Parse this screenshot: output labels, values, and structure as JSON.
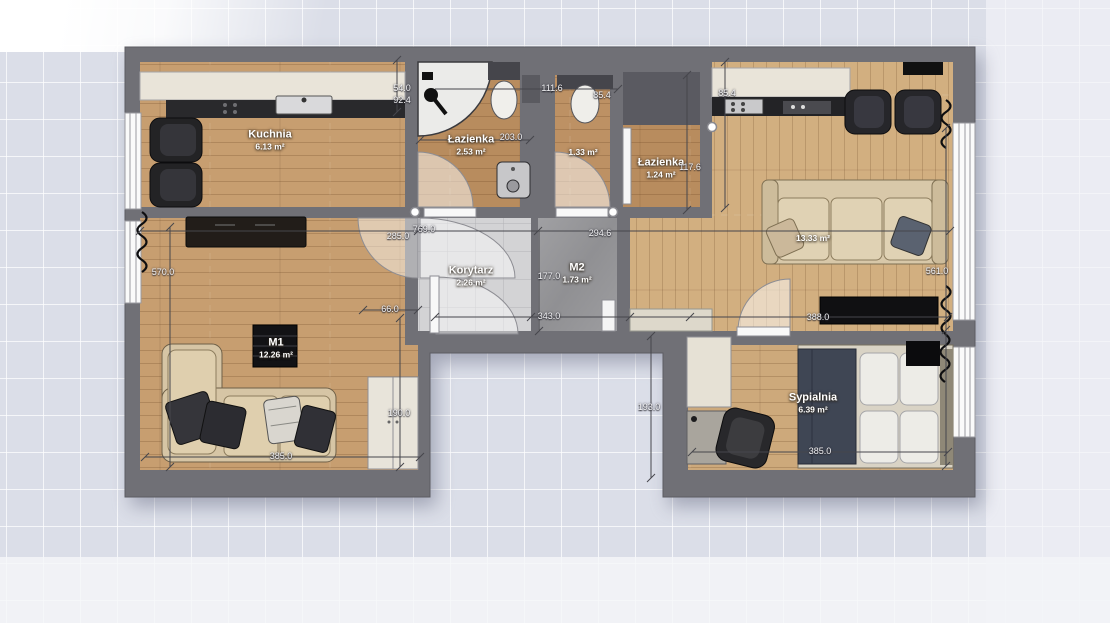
{
  "rooms": {
    "kuchnia": {
      "name": "Kuchnia",
      "area": "6.13 m²"
    },
    "lazienka_1": {
      "name": "Łazienka",
      "area": "2.53 m²"
    },
    "wc": {
      "area": "1.33 m²"
    },
    "lazienka_2": {
      "name": "Łazienka",
      "area": "1.24 m²"
    },
    "korytarz": {
      "name": "Korytarz",
      "area": "2.26 m²"
    },
    "m2": {
      "name": "M2",
      "area": "1.73 m²"
    },
    "m1": {
      "name": "M1",
      "area": "12.26 m²"
    },
    "salon": {
      "area": "13.33 m²"
    },
    "sypialnia": {
      "name": "Sypialnia",
      "area": "6.39 m²"
    }
  },
  "dims": {
    "left_block_height": "570.0",
    "right_block_height": "561.0",
    "kitchen_width": "285.0",
    "total_width": "769.0",
    "living_width": "294.6",
    "hall_height": "177.0",
    "hall_width": "343.0",
    "wardrobe_width": "66.0",
    "m1_height": "190.0",
    "m1_width": "385.0",
    "bedroom_width": "385.0",
    "tv_wall_width": "388.0",
    "notch_height": "193.0",
    "wc_width_outer": "111.6",
    "wc_width_inner": "85.4",
    "counter_width": "85.4",
    "bath_width": "203.0",
    "bath2_height": "117.6",
    "shaft_dim_a": "54.0",
    "shaft_dim_b": "92.4"
  },
  "colors": {
    "canvas_grid_bg": "#dbdee8",
    "wall": "#707076",
    "wood_floor": "#c79e70",
    "wood_floor_light": "#d2af80",
    "tile_floor": "#d3d3d5",
    "concrete_floor": "#98989b",
    "label_text": "#ffffff",
    "dimension_text": "#f2f2f4"
  }
}
